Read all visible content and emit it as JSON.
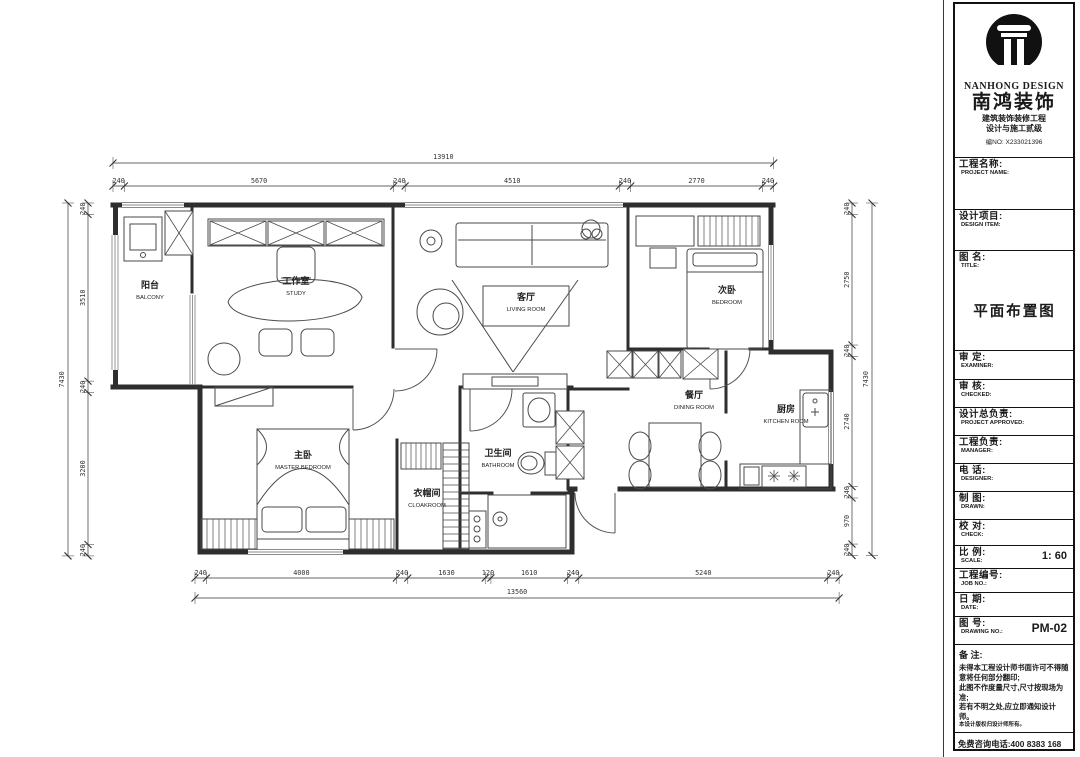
{
  "colors": {
    "line": "#2e2e2e",
    "paper": "#ffffff"
  },
  "sidebar": {
    "brand": {
      "logo_en": "NANHONG DESIGN",
      "logo_zh": "南鸿装饰",
      "cert1": "建筑装饰装修工程",
      "cert2": "设计与施工贰级",
      "cert_no": "编NO: X233021396"
    },
    "fields": [
      {
        "id": "project-name",
        "zh": "工程名称:",
        "en": "PROJECT NAME:",
        "value": ""
      },
      {
        "id": "design-item",
        "zh": "设计项目:",
        "en": "DESIGN ITEM:",
        "value": ""
      },
      {
        "id": "title",
        "zh": "图  名:",
        "en": "TITLE:",
        "value": "平面布置图",
        "emphasis": "large"
      },
      {
        "id": "examiner",
        "zh": "审  定:",
        "en": "EXAMINER:",
        "value": ""
      },
      {
        "id": "checked",
        "zh": "审  核:",
        "en": "CHECKED:",
        "value": ""
      },
      {
        "id": "approved",
        "zh": "设计总负责:",
        "en": "PROJECT APPROVED:",
        "value": ""
      },
      {
        "id": "manager",
        "zh": "工程负责:",
        "en": "MANAGER:",
        "value": ""
      },
      {
        "id": "phone",
        "zh": "电  话:",
        "en": "DESIGNER:",
        "value": ""
      },
      {
        "id": "drawn",
        "zh": "制  图:",
        "en": "DRAWN:",
        "value": ""
      },
      {
        "id": "check",
        "zh": "校  对:",
        "en": "CHECK:",
        "value": ""
      },
      {
        "id": "scale",
        "zh": "比  例:",
        "en": "SCALE:",
        "value": "1: 60",
        "emphasis": "right"
      },
      {
        "id": "job-no",
        "zh": "工程编号:",
        "en": "JOB NO.:",
        "value": ""
      },
      {
        "id": "date",
        "zh": "日  期:",
        "en": "DATE:",
        "value": ""
      },
      {
        "id": "drawing-no",
        "zh": "图  号:",
        "en": "DRAWING NO.:",
        "value": "PM-02",
        "emphasis": "right"
      }
    ],
    "notes": {
      "title": "备  注:",
      "lines": [
        "未得本工程设计师书面许可不得随意将任何部分翻印;",
        "此图不作度量尺寸,尺寸按现场为准;",
        "若有不明之处,应立即通知设计师。",
        "本设计版权归设计师所有。"
      ],
      "hotline": "免费咨询电话:400 8383 168"
    }
  },
  "plan": {
    "rooms": [
      {
        "id": "balcony",
        "zh": "阳台",
        "en": "BALCONY"
      },
      {
        "id": "study",
        "zh": "工作室",
        "en": "STUDY"
      },
      {
        "id": "living",
        "zh": "客厅",
        "en": "LIVING ROOM"
      },
      {
        "id": "bedroom2",
        "zh": "次卧",
        "en": "BEDROOM"
      },
      {
        "id": "dining",
        "zh": "餐厅",
        "en": "DINING ROOM"
      },
      {
        "id": "kitchen",
        "zh": "厨房",
        "en": "KITCHEN ROOM"
      },
      {
        "id": "master",
        "zh": "主卧",
        "en": "MASTER BEDROOM"
      },
      {
        "id": "cloakroom",
        "zh": "衣帽间",
        "en": "CLOAKROOM"
      },
      {
        "id": "bathroom",
        "zh": "卫生间",
        "en": "BATHROOM"
      }
    ],
    "dims": {
      "top": {
        "total": "13910",
        "segments": [
          "240",
          "5670",
          "240",
          "4510",
          "240",
          "2770",
          "240"
        ]
      },
      "bottom": {
        "total": "13560",
        "segments": [
          "240",
          "4000",
          "240",
          "1630",
          "120",
          "1610",
          "240",
          "5240",
          "240"
        ]
      },
      "left": {
        "total": "7430",
        "segments": [
          "240",
          "3510",
          "240",
          "3200",
          "240"
        ]
      },
      "right": {
        "total": "7430",
        "segments": [
          "240",
          "2750",
          "240",
          "2740",
          "240",
          "970",
          "240"
        ]
      }
    }
  }
}
